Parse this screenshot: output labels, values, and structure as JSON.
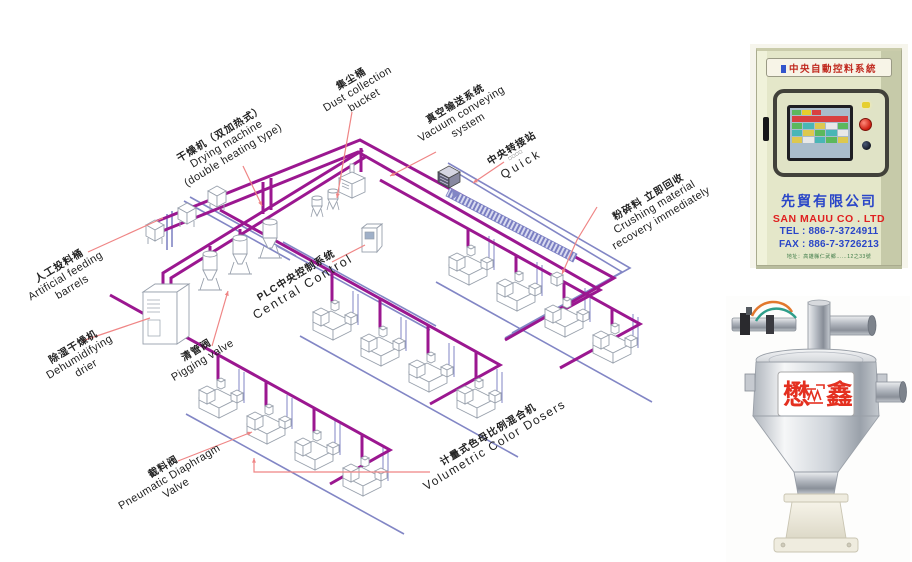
{
  "diagram": {
    "colors": {
      "pipe_purple": "#9b1790",
      "pipe_blue": "#8286c5",
      "leader_red": "#ef8585",
      "machine_stroke": "#98a0ac",
      "band_stripe": "#7a7ec2"
    },
    "labels": [
      {
        "id": "artificial-feeding-barrels",
        "cn": "人工投料桶",
        "en1": "Artificial feeding",
        "en2": "barrels",
        "x": 66,
        "y": 277,
        "rot": -31
      },
      {
        "id": "drying-machine",
        "cn": "干燥机（双加热式）",
        "en1": "Drying machine",
        "en2": "(double heating type)",
        "x": 227,
        "y": 145,
        "rot": -31
      },
      {
        "id": "dust-collection-bucket",
        "cn": "集尘桶",
        "en1": "Dust collection",
        "en2": "bucket",
        "x": 358,
        "y": 90,
        "rot": -31
      },
      {
        "id": "vacuum-conveying-system",
        "cn": "真空输送系统",
        "en1": "Vacuum conveying",
        "en2": "system",
        "x": 462,
        "y": 115,
        "rot": -31
      },
      {
        "id": "central-transfer-station",
        "cn": "中央转接站",
        "en1": "□□□□",
        "en2": "Quick",
        "x": 517,
        "y": 157,
        "rot": -31
      },
      {
        "id": "crushing-material-recovery",
        "cn": "粉碎料 立即回收",
        "en1": "Crushing material",
        "en2": "recovery immediately",
        "x": 655,
        "y": 208,
        "rot": -31
      },
      {
        "id": "plc-central-control",
        "cn": "PLC中央控制系统",
        "en1": "Central Control",
        "en2": "",
        "x": 300,
        "y": 282,
        "rot": -31
      },
      {
        "id": "dehumidifying-drier",
        "cn": "除湿干燥机",
        "en1": "Dehumidifying",
        "en2": "drier",
        "x": 80,
        "y": 358,
        "rot": -31
      },
      {
        "id": "pigging-valve",
        "cn": "清管阀",
        "en1": "Pigging valve",
        "en2": "",
        "x": 200,
        "y": 356,
        "rot": -31
      },
      {
        "id": "pneumatic-diaphragm-valve",
        "cn": "截料阀",
        "en1": "Pneumatic Diaphragm",
        "en2": "Valve",
        "x": 170,
        "y": 478,
        "rot": -31
      },
      {
        "id": "volumetric-color-dosers",
        "cn": "计量式色母比例混合机",
        "en1": "Volumetric Color Dosers",
        "en2": "",
        "x": 492,
        "y": 441,
        "rot": -31
      }
    ],
    "pipes_purple": [
      "M150 224 L360 140 L614 278 L505 340",
      "M160 232 L358 152 L600 290 L545 320",
      "M163 301 L163 273 L363 150",
      "M171 306 L171 278 L367 156",
      "M380 180 L640 324 L560 368",
      "M220 210 L500 365 L430 404",
      "M110 295 L390 450 L330 484",
      "M263 182 L263 214",
      "M271 178 L271 210",
      "M210 246 L210 254",
      "M240 229 L240 240",
      "M468 229 L468 247",
      "M516 255 L516 273",
      "M564 282 L564 299",
      "M612 308 L612 325",
      "M332 272 L332 302",
      "M380 299 L380 328",
      "M428 325 L428 354",
      "M476 352 L476 380",
      "M218 355 L218 380",
      "M266 381 L266 406",
      "M314 408 L314 432",
      "M362 435 L362 458",
      "M361 148 L361 172"
    ],
    "pipes_blue": [
      "M448 163 L630 268 L505 338",
      "M454 171 L622 272 L512 333",
      "M184 201 L290 260",
      "M190 197 L296 256",
      "M277 246 L430 330",
      "M283 242 L436 326",
      "M436 282 L652 402",
      "M300 336 L518 457",
      "M186 414 L404 534",
      "M167 214 L167 250",
      "M172 211 L172 247"
    ],
    "band": [
      450,
      188,
      577,
      254,
      573,
      262,
      446,
      196
    ],
    "band_arrow": [
      461,
      193,
      452,
      189,
      453,
      199
    ],
    "leaders": [
      {
        "pts": [
          88,
          252,
          163,
          218
        ],
        "arrow": false
      },
      {
        "pts": [
          243,
          166,
          262,
          206
        ],
        "arrow": true
      },
      {
        "pts": [
          352,
          112,
          337,
          198
        ],
        "arrow": true
      },
      {
        "pts": [
          436,
          152,
          390,
          176
        ],
        "arrow": true
      },
      {
        "pts": [
          504,
          162,
          473,
          183
        ],
        "arrow": true
      },
      {
        "pts": [
          597,
          207,
          577,
          240,
          562,
          274
        ],
        "arrow": true
      },
      {
        "pts": [
          332,
          262,
          365,
          245
        ],
        "arrow": false
      },
      {
        "pts": [
          82,
          341,
          150,
          318
        ],
        "arrow": false
      },
      {
        "pts": [
          212,
          346,
          228,
          291
        ],
        "arrow": true
      },
      {
        "pts": [
          178,
          461,
          252,
          432
        ],
        "arrow": true
      },
      {
        "pts": [
          430,
          472,
          254,
          472,
          254,
          458
        ],
        "arrow": true
      }
    ],
    "machines": [
      [
        468,
        264
      ],
      [
        516,
        290
      ],
      [
        564,
        316
      ],
      [
        612,
        342
      ],
      [
        332,
        319
      ],
      [
        380,
        345
      ],
      [
        428,
        371
      ],
      [
        476,
        397
      ],
      [
        218,
        397
      ],
      [
        266,
        423
      ],
      [
        314,
        449
      ],
      [
        362,
        475
      ]
    ],
    "barrels": [
      [
        155,
        228
      ],
      [
        187,
        211
      ],
      [
        217,
        194
      ]
    ],
    "dryer_hoppers": [
      [
        210,
        268
      ],
      [
        240,
        252
      ],
      [
        270,
        236
      ]
    ],
    "cyclones": [
      [
        317,
        207
      ],
      [
        333,
        200
      ]
    ],
    "vacuum_pump": [
      352,
      182
    ],
    "transfer_station": [
      449,
      175
    ],
    "plc_box": [
      370,
      230
    ],
    "crusher": [
      557,
      277
    ],
    "dehumidifier": [
      143,
      286
    ]
  },
  "cabinet": {
    "banner": "中央自動控料系統",
    "company_cn": "先貿有限公司",
    "company_en": "SAN MAUU CO . LTD",
    "tel": "TEL : 886-7-3724911",
    "fax": "FAX : 886-7-3726213",
    "address": "地址：高雄縣仁武鄉……12之33號",
    "screen": {
      "buttons": [
        "#5cb85c",
        "#e6cf2e",
        "#d84040"
      ],
      "banner": "#d84040",
      "grid": [
        [
          "#5cb85c",
          "#49b6b6",
          "#ddc84e",
          "#e8e8e8",
          "#5cb85c"
        ],
        [
          "#49b6b6",
          "#ddc84e",
          "#5cb85c",
          "#49b6b6",
          "#e8e8e8"
        ],
        [
          "#ddc84e",
          "#e8e8e8",
          "#49b6b6",
          "#5cb85c",
          "#ddc84e"
        ]
      ]
    }
  },
  "loader": {
    "brand_left": "懋",
    "brand_right": "鑫"
  }
}
